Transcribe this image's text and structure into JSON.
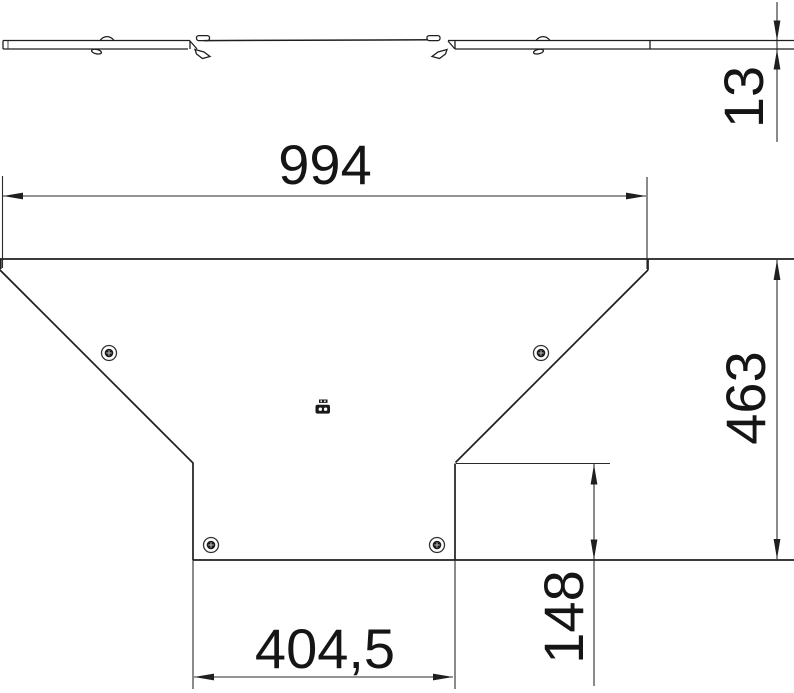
{
  "colors": {
    "outline": "#1f1f1f",
    "dimension_line": "#2a2a2a",
    "text": "#151515",
    "background": "#ffffff",
    "screw_fill": "#1a1a1a"
  },
  "views": {
    "side_profile": {
      "thickness_dim": {
        "value": "13",
        "orientation": "rotated-90"
      }
    },
    "plan": {
      "overall_width_dim": {
        "value": "994"
      },
      "overall_depth_dim": {
        "value": "463",
        "orientation": "rotated-90"
      },
      "branch_width_dim": {
        "value": "404,5"
      },
      "branch_offset_dim": {
        "value": "148",
        "orientation": "rotated-90"
      }
    }
  },
  "icons": {
    "screw": "torx-screw-head-icon",
    "stamp": "manufacturer-stamp-icon",
    "latch": "turnbuckle-latch-icon",
    "rivet": "rivet-head-icon"
  }
}
